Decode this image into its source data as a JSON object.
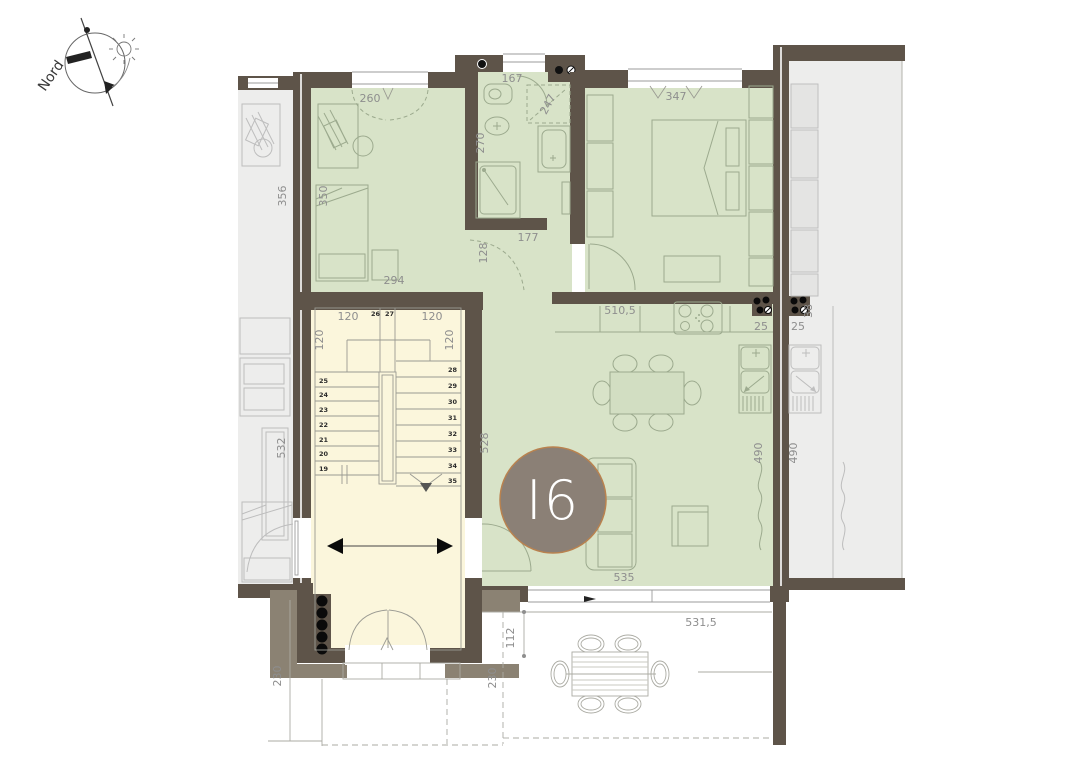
{
  "compass": {
    "label": "Nord"
  },
  "badge": {
    "label": "I6",
    "fill": "#8B8076",
    "border": "#B9824F"
  },
  "colors": {
    "apartment_green": "#D8E3C8",
    "stairwell_cream": "#FBF6DC",
    "neighbor_gray": "#EDEDEC",
    "wall_dark": "#5E5449",
    "wall_taupe": "#8B8273",
    "dimension_text": "#8E8E8E"
  },
  "dims": {
    "study_window": "260",
    "bath_width": "167",
    "bedroom_window": "347",
    "left_unit_room": "356",
    "study_width": "350",
    "study_depth": "294",
    "bath_depth": "270",
    "laundry_niche": "247",
    "hall_width": "128",
    "bath_wall": "177",
    "kitchen_run": "510,5",
    "shaft_left": "25",
    "shaft_right": "25",
    "shaft_size": "38",
    "left_unit_kitchen": "532",
    "living_depth": "528",
    "living_width": "535",
    "kitchen_wall": "490",
    "neighbor_kitchen_wall": "490",
    "terrace_width": "531,5",
    "terrace_depth": "112",
    "left_terrace_depth": "230",
    "terrace_side_depth": "230",
    "stair_top_left": "120",
    "stair_top_right": "120",
    "stair_flight_left": "120",
    "stair_flight_right": "120"
  },
  "stairs": {
    "left_steps": [
      "25",
      "24",
      "23",
      "22",
      "21",
      "20",
      "19"
    ],
    "mid_steps": [
      "26",
      "27"
    ],
    "right_steps": [
      "28",
      "29",
      "30",
      "31",
      "32",
      "33",
      "34",
      "35"
    ]
  }
}
